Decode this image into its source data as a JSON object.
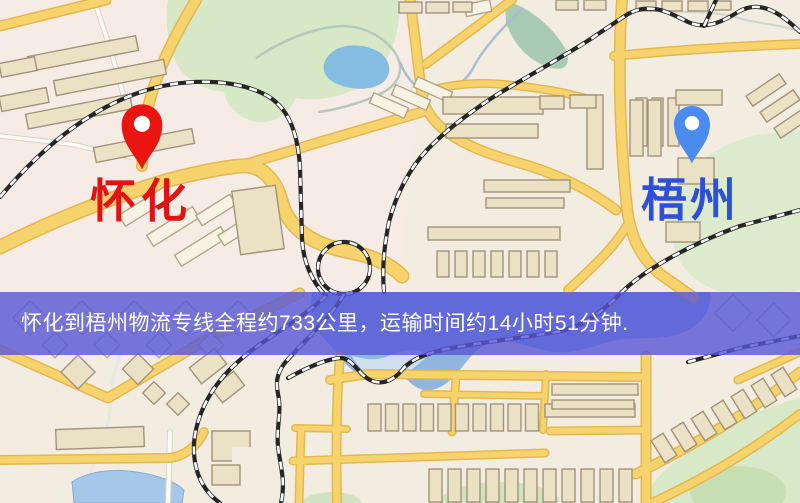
{
  "map": {
    "origin": {
      "label": "怀化",
      "label_color": "#e31212",
      "pin_color": "#ea1510"
    },
    "destination": {
      "label": "梧州",
      "label_color": "#2e4fd8",
      "pin_color": "#4b8bf0"
    },
    "banner": {
      "text": "怀化到梧州物流专线全程约733公里，运输时间约14小时51分钟.",
      "distance_text": "733公里",
      "duration_text": "14小时51分钟",
      "bg_color": "#5656d7",
      "text_color": "#ffffff"
    },
    "icons": {
      "origin_pin": "red-location-pin-icon",
      "destination_pin": "blue-location-pin-icon"
    }
  }
}
